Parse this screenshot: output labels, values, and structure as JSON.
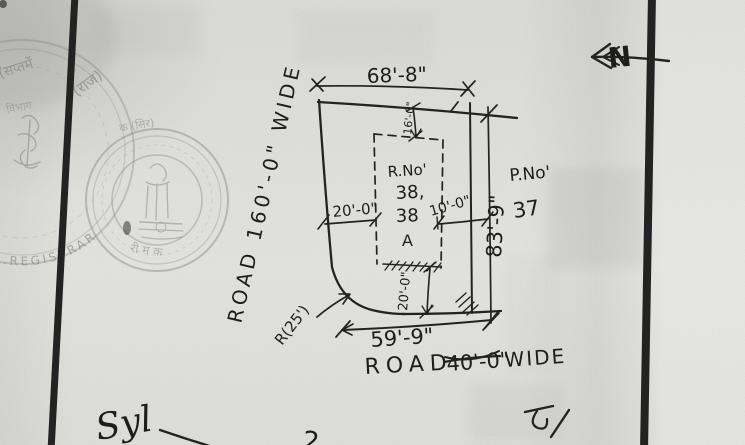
{
  "plan": {
    "north_label": "N",
    "dimensions": {
      "top_width": "68'-8\"",
      "right_height": "83'-9\"",
      "bottom_width": "59'-9\"",
      "left_offset": "20'-0\"",
      "right_offset": "10'-0\"",
      "top_offset": "16'-0\"",
      "bottom_offset": "20'-0\"",
      "corner_radius": "R(25')"
    },
    "plot": {
      "label": "R.No'",
      "number_line1": "38,",
      "number_line2": "38",
      "number_line3": "A"
    },
    "adjacent_plot": {
      "label": "P.No'",
      "number": "37"
    },
    "roads": {
      "left": "ROAD 160'-0\" WIDE",
      "bottom_word1": "ROAD",
      "bottom_width_struck": "40'-0\"",
      "bottom_word2": "WIDE"
    }
  },
  "stamps": {
    "large": {
      "arc_top_left": "(सप्तमें",
      "arc_top": "(राज)",
      "arc_left": "विभाग",
      "arc_bottom": "R.REGISTRAR"
    },
    "small": {
      "band_top": "क (सिर)",
      "band_bottom": "री म क"
    }
  },
  "annotations": {
    "signature": "Syl",
    "partial_digit": "2",
    "script_mark": "ढ/"
  }
}
